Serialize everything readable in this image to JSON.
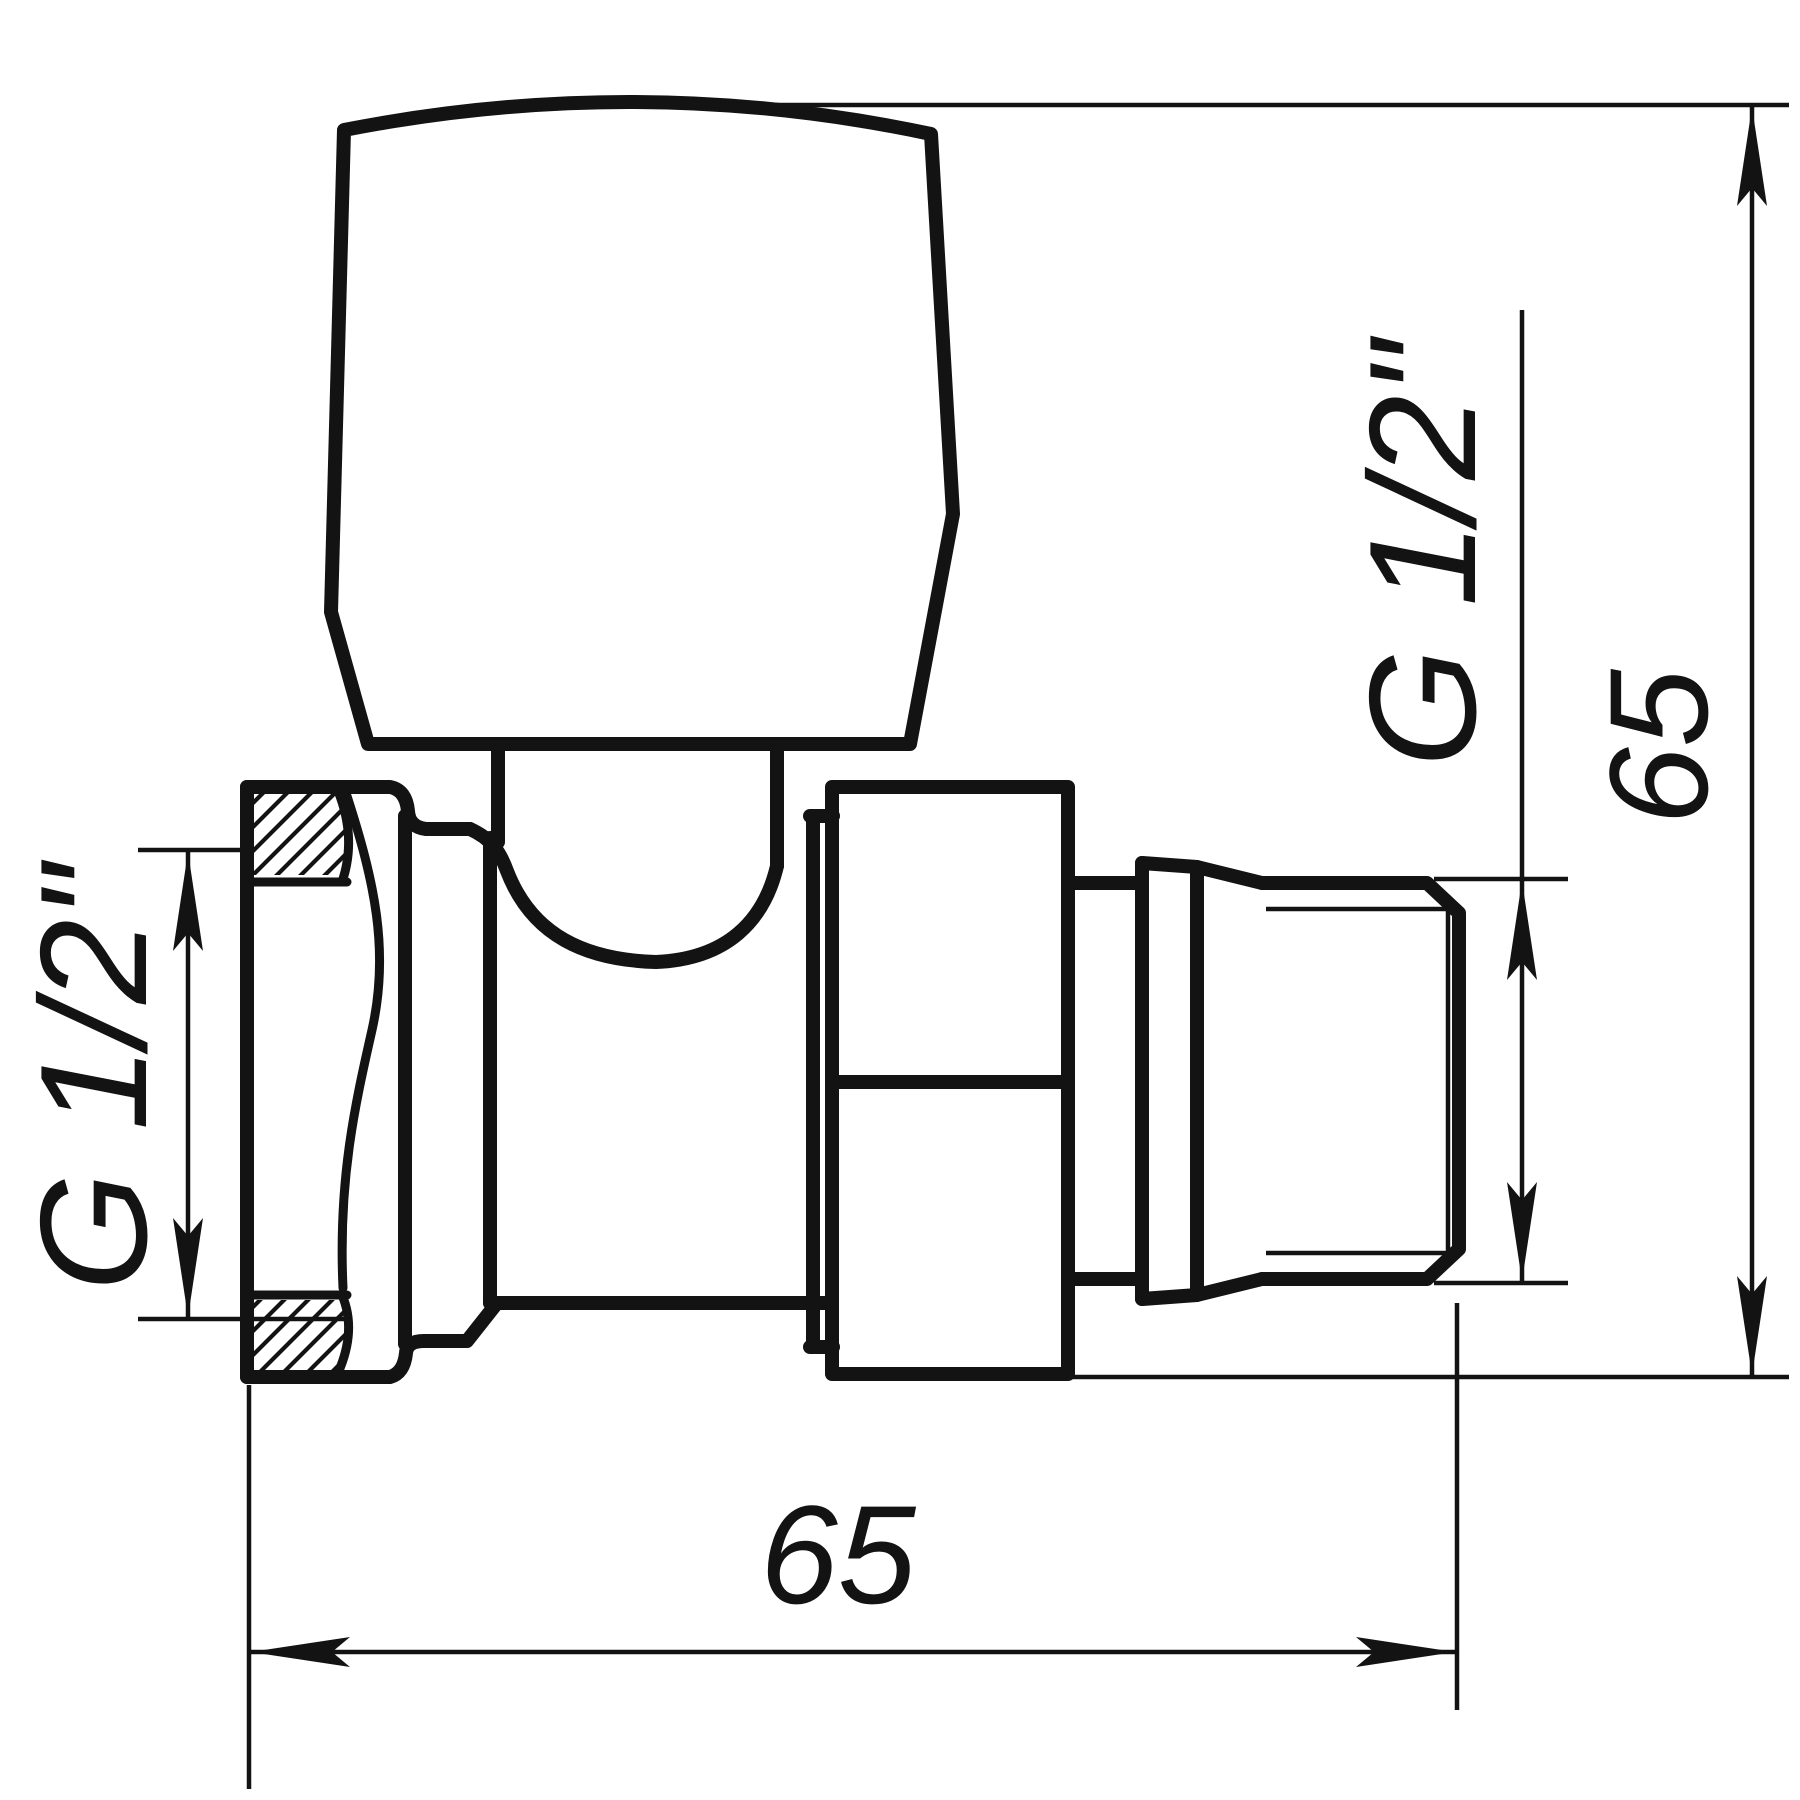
{
  "drawing": {
    "colors": {
      "line": "#131313",
      "background": "#ffffff"
    },
    "dimensions": {
      "left_thread_label": "G 1/2\"",
      "right_thread_label": "G 1/2\"",
      "overall_height_label": "65",
      "overall_length_label": "65"
    }
  }
}
